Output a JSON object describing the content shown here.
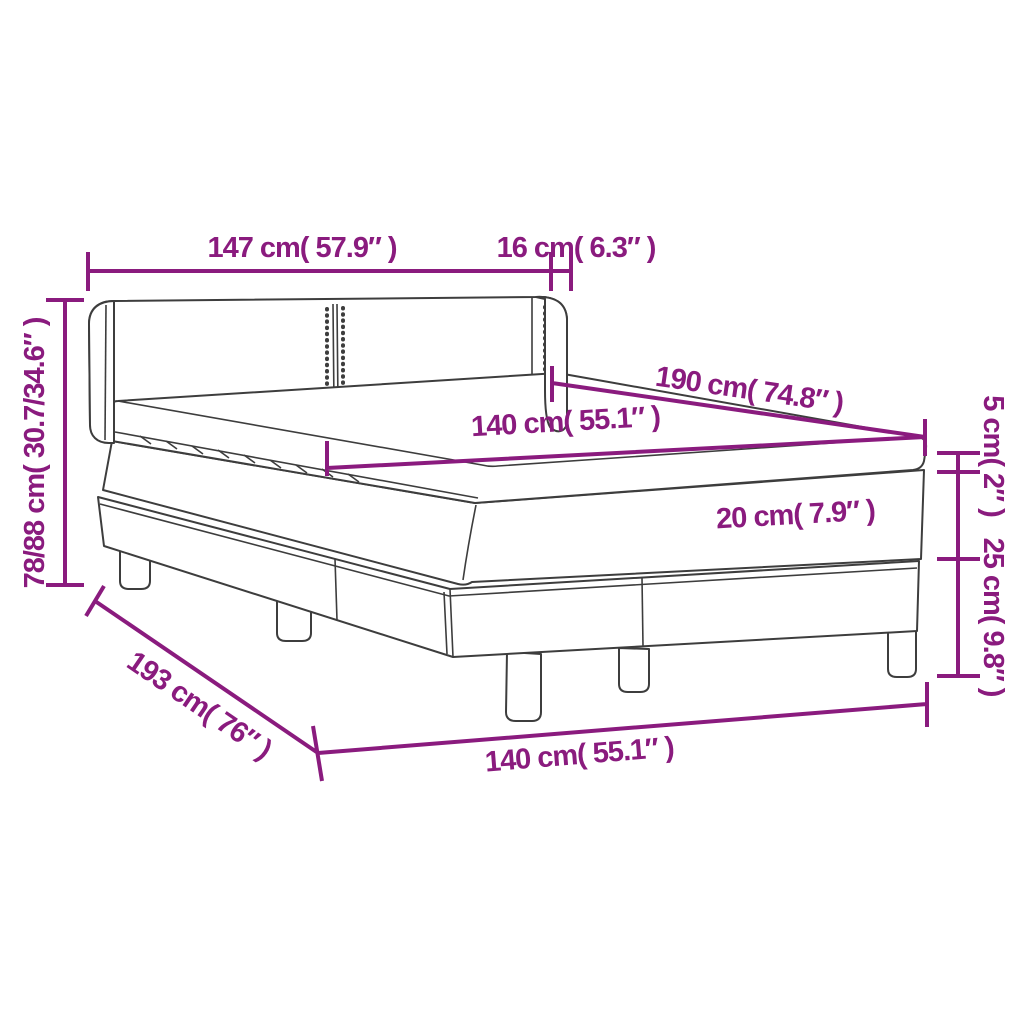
{
  "diagram": {
    "title": "Box spring bed with headboard and topper - dimension diagram",
    "accent_color": "#8a1b7e",
    "line_color": "#3d3d3d",
    "background_color": "#ffffff",
    "dimensions": {
      "headboard_width": "147 cm( 57.9″ )",
      "wing_depth": "16 cm( 6.3″ )",
      "height_range": "78/88 cm( 30.7/34.6″ )",
      "mattress_length": "190 cm( 74.8″ )",
      "mattress_width_top": "140 cm( 55.1″ )",
      "topper_height": "5 cm( 2″ )",
      "mattress_thickness": "20 cm( 7.9″ )",
      "base_height": "25 cm( 9.8″ )",
      "total_length": "193 cm( 76″ )",
      "mattress_width_bottom": "140 cm( 55.1″ )"
    }
  }
}
